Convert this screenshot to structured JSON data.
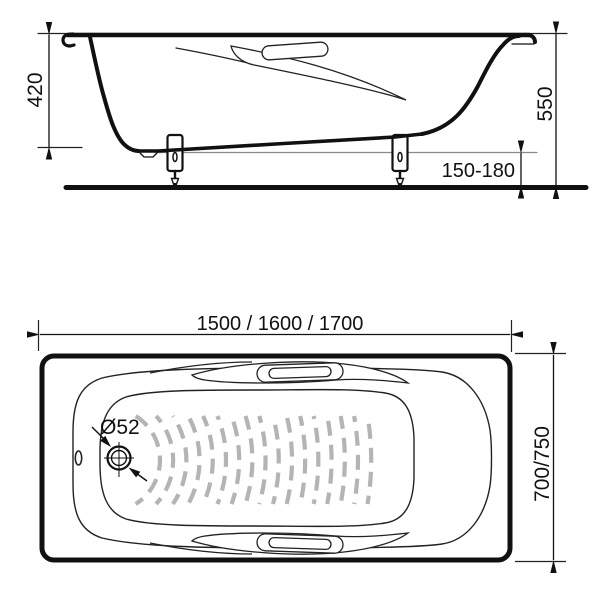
{
  "side_view": {
    "depth_dim": "420",
    "height_dim": "550",
    "floor_gap_dim": "150-180"
  },
  "plan_view": {
    "length_dim": "1500 / 1600 / 1700",
    "width_dim": "700/750",
    "drain_dim": "Ø52"
  },
  "colors": {
    "line": "#111111",
    "thin_line": "#222222",
    "reference_line": "#888888",
    "pattern": "#b4b4b4",
    "background": "#ffffff"
  }
}
